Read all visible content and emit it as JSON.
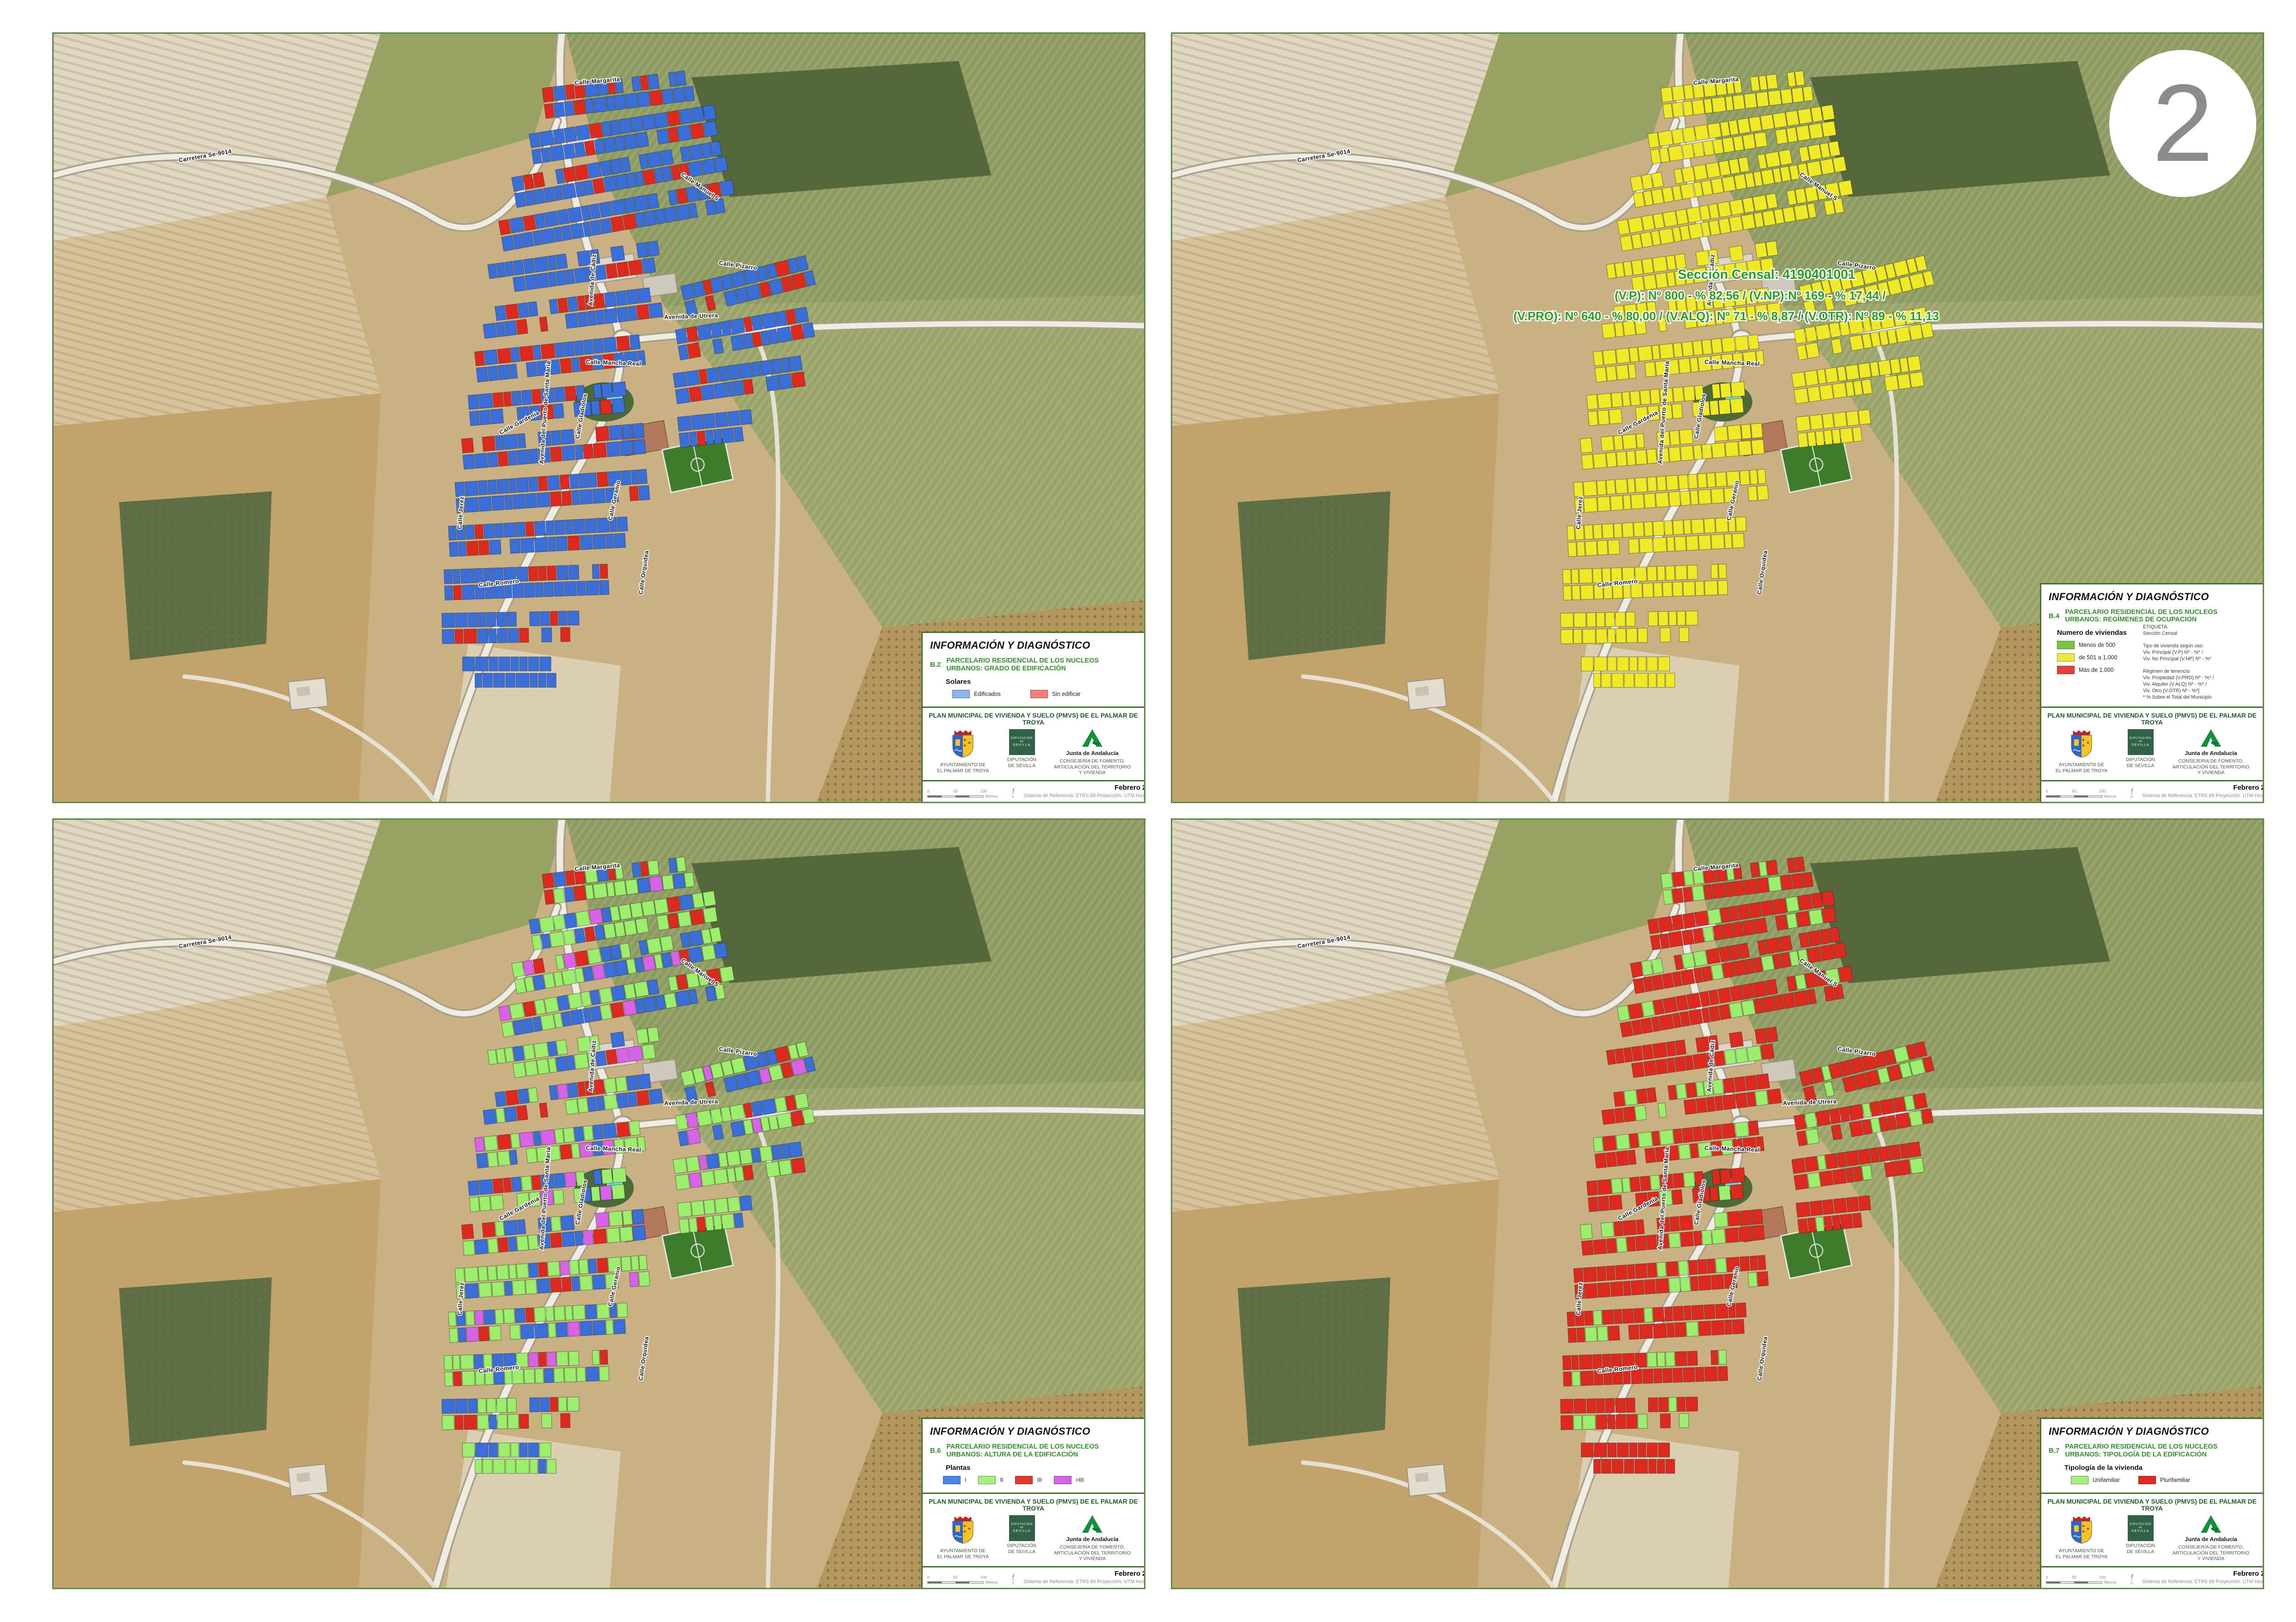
{
  "sheet": {
    "number": "2"
  },
  "shared": {
    "header_title": "INFORMACIÓN Y DIAGNÓSTICO",
    "plan_title": "PLAN MUNICIPAL DE VIVIENDA Y SUELO (PMVS) DE EL PALMAR DE TROYA",
    "date": "Febrero 2024",
    "reference": "Sistema de Referencia: ETRS 89 Proyección: UTM Huso 30N",
    "scale": {
      "tick0": "0",
      "tick50": "50",
      "tick100": "100",
      "unit": "Metros",
      "north": "N"
    },
    "logos": [
      {
        "caption_line1": "AYUNTAMIENTO DE",
        "caption_line2": "EL PALMAR DE TROYA"
      },
      {
        "logo_line1": "DIPUTACIÓN",
        "logo_line2": "DE",
        "logo_line3": "SEVILLA",
        "caption_line1": "DIPUTACIÓN",
        "caption_line2": "DE SEVILLA"
      },
      {
        "name": "Junta de Andalucía",
        "caption_line1": "CONSEJERÍA DE FOMENTO,",
        "caption_line2": "ARTICULACIÓN DEL TERRITORIO",
        "caption_line3": "Y VIVIENDA"
      }
    ],
    "street_labels": [
      "Carretera Se-9014",
      "Calle Margarita",
      "Avenida del Puerto de Santa María",
      "Avenida de Cádiz",
      "Calle Manuel S",
      "Calle Pizarro",
      "Avenida de Utrera",
      "Calle Mancha Real",
      "Calle Gardenia",
      "Calle Gladiolos",
      "Calle Geranio",
      "Calle Orquídea",
      "Calle Romero",
      "Calle Jerez"
    ]
  },
  "panels": [
    {
      "code": "B.2",
      "title": "PARCELARIO RESIDENCIAL DE LOS NUCLEOS URBANOS: GRADO DE EDIFICACIÓN",
      "legend_heading": "Solares",
      "legend_items": [
        {
          "label": "Edificados",
          "color": "#8AB6F0"
        },
        {
          "label": "Sin edificar",
          "color": "#F08078"
        }
      ],
      "parcel_colors": [
        "#3A6ED8",
        "#3A6ED8",
        "#DE2A1E",
        "#DE2A1E"
      ]
    },
    {
      "code": "B.4",
      "title": "PARCELARIO RESIDENCIAL DE LOS NUCLEOS URBANOS: REGÍMENES DE OCUPACIÓN",
      "legend_heading": "Numero de viviendas",
      "legend_items": [
        {
          "label": "Menos de 500",
          "color": "#7DC242"
        },
        {
          "label": "de 501 a 1.000",
          "color": "#EDE93F"
        },
        {
          "label": "Más de 1.000",
          "color": "#E2403A"
        }
      ],
      "notes": [
        "ETIQUETA:",
        "Sección Censal",
        "",
        "Tipo de vivienda según uso:",
        "Viv. Principal (V.P) Nº - %* /",
        "Viv. No Principal (V.NP) Nº - %*",
        "",
        "Régimen de tenencia:",
        "Viv. Propiedad (V.PRO) Nº - %* /",
        "Viv. Alquiler (V.ALQ) Nº - %* /",
        "Viv. Otro (V.OTR) Nº - %*]",
        "* % Sobre el Total del Municipio"
      ],
      "map_label": {
        "line1": "Sección Censal: 4190401001",
        "line2": "(V.P): Nº 800 - % 82,56 / (V.NP):Nº 169 - % 17,44 /",
        "line3": "(V.PRO): Nº 640 - % 80,00 / (V.ALQ): Nº 71 - % 8,87 / (V.OTR): Nº 89 - % 11,13"
      },
      "parcel_colors": [
        "#EFEA25",
        "#EFEA25",
        "#EFEA25",
        "#EFEA25"
      ]
    },
    {
      "code": "B.6",
      "title": "PARCELARIO RESIDENCIAL DE LOS NUCLEOS URBANOS: ALTURA DE LA EDIFICACIÓN",
      "legend_heading": "Plantas",
      "legend_items": [
        {
          "label": "I",
          "color": "#4A86E8"
        },
        {
          "label": "II",
          "color": "#A5F07D"
        },
        {
          "label": "III",
          "color": "#E23A30"
        },
        {
          "label": ">III",
          "color": "#D863E8"
        }
      ],
      "parcel_colors": [
        "#9CEF6C",
        "#3A6ED8",
        "#DE2A1E",
        "#D863E8"
      ]
    },
    {
      "code": "B.7",
      "title": "PARCELARIO RESIDENCIAL DE LOS NUCLEOS URBANOS: TIPOLOGÍA DE LA EDIFICACIÓN",
      "legend_heading": "Tipología de la vivienda",
      "legend_items": [
        {
          "label": "Unifamiliar",
          "color": "#A5F07D"
        },
        {
          "label": "Plurifamiliar",
          "color": "#DF2B20"
        }
      ],
      "parcel_colors": [
        "#DE2A1E",
        "#DE2A1E",
        "#9CEF6C",
        "#9CEF6C"
      ]
    }
  ]
}
